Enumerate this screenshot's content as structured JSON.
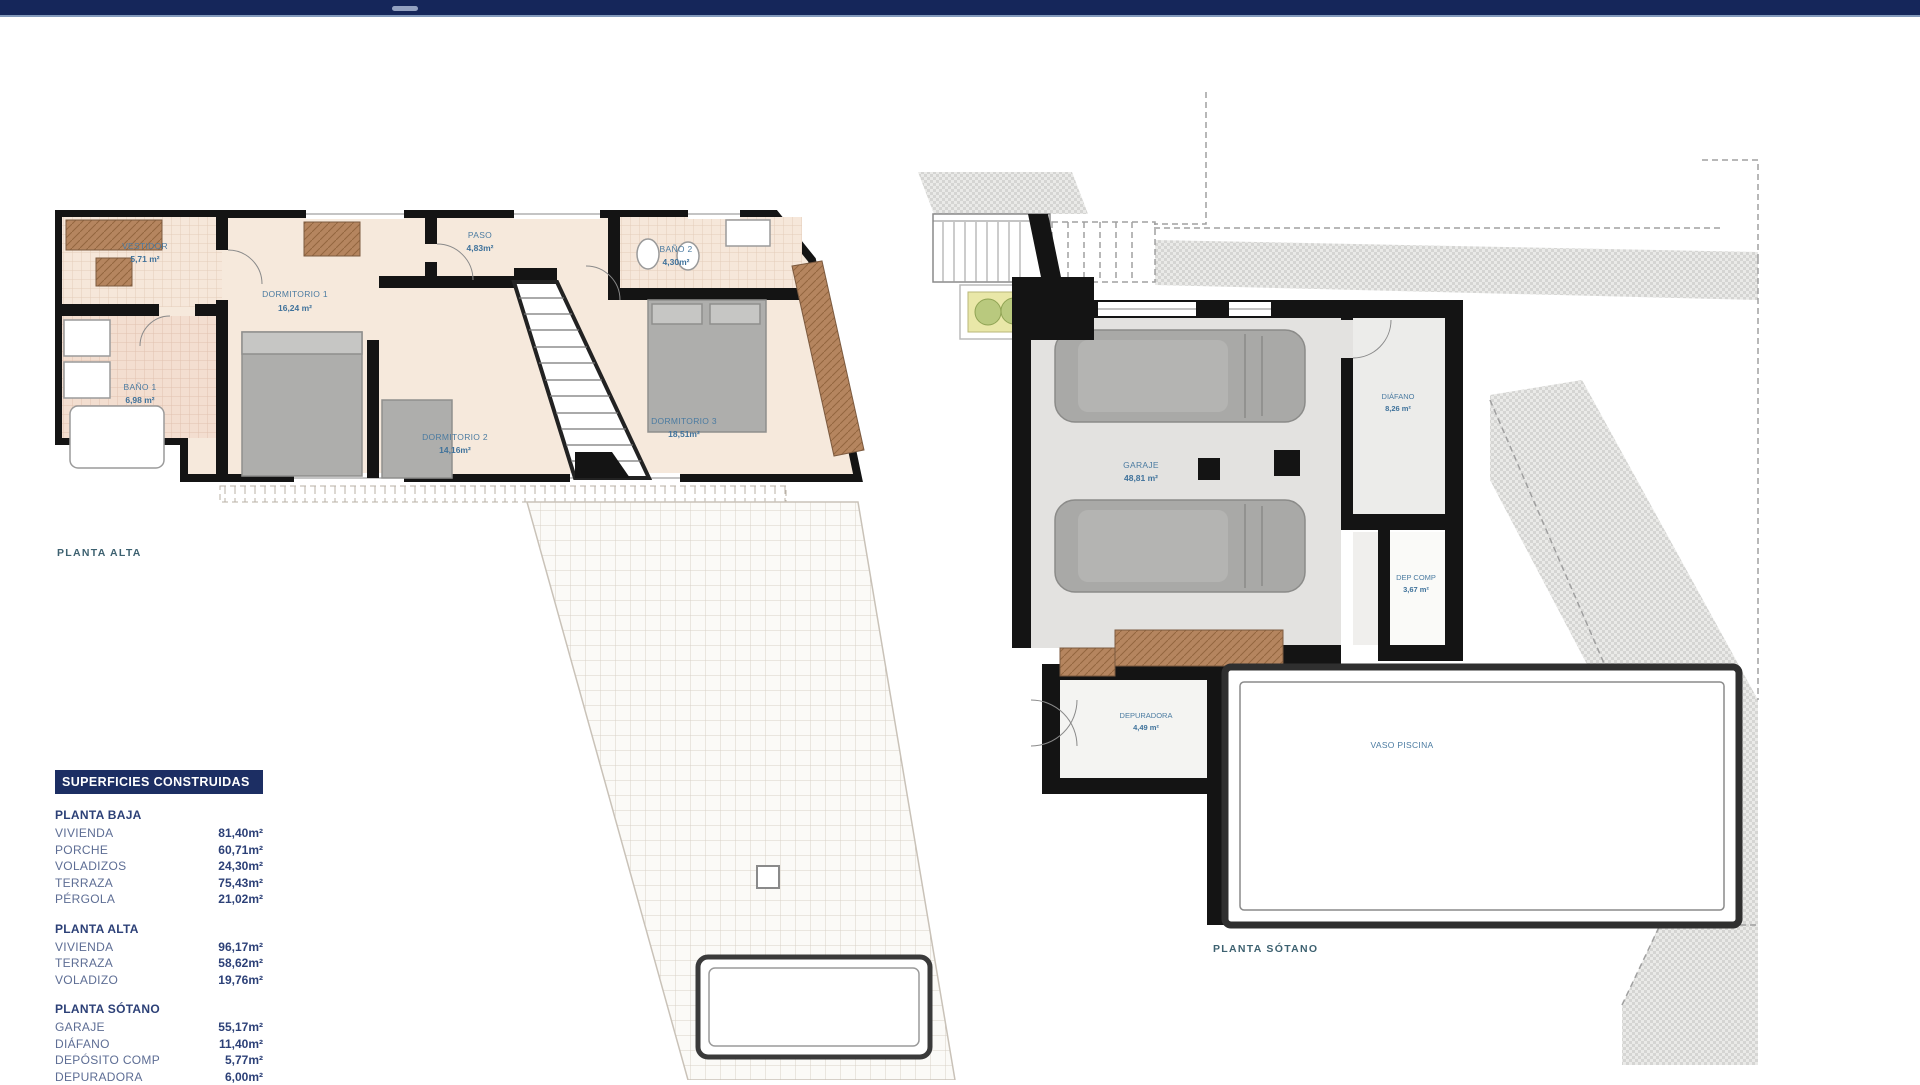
{
  "window": {
    "top_bar_color": "#15265a"
  },
  "plans": {
    "planta_alta": {
      "caption": "PLANTA ALTA",
      "rooms": {
        "vestidor": {
          "name": "VESTIDOR",
          "area": "5,71 m²"
        },
        "paso": {
          "name": "PASO",
          "area": "4,83m²"
        },
        "bano2": {
          "name": "BAÑO 2",
          "area": "4,30m²"
        },
        "dormitorio1": {
          "name": "DORMITORIO 1",
          "area": "16,24 m²"
        },
        "bano1": {
          "name": "BAÑO 1",
          "area": "6,98 m²"
        },
        "dormitorio2": {
          "name": "DORMITORIO 2",
          "area": "14,16m²"
        },
        "dormitorio3": {
          "name": "DORMITORIO 3",
          "area": "18,51m²"
        }
      }
    },
    "planta_sotano": {
      "caption": "PLANTA SÓTANO",
      "rooms": {
        "garaje": {
          "name": "GARAJE",
          "area": "48,81 m²"
        },
        "diafano": {
          "name": "DIÁFANO",
          "area": "8,26 m²"
        },
        "dep_comp": {
          "name": "DEP COMP",
          "area": "3,67 m²"
        },
        "depuradora": {
          "name": "DEPURADORA",
          "area": "4,49 m²"
        },
        "vaso_piscina": {
          "name": "VASO PISCINA"
        }
      }
    }
  },
  "legend": {
    "title": "SUPERFICIES CONSTRUIDAS",
    "sections": [
      {
        "heading": "PLANTA BAJA",
        "rows": [
          {
            "label": "VIVIENDA",
            "value": "81,40m²"
          },
          {
            "label": "PORCHE",
            "value": "60,71m²"
          },
          {
            "label": "VOLADIZOS",
            "value": "24,30m²"
          },
          {
            "label": "TERRAZA",
            "value": "75,43m²"
          },
          {
            "label": "PÉRGOLA",
            "value": "21,02m²"
          }
        ]
      },
      {
        "heading": "PLANTA ALTA",
        "rows": [
          {
            "label": "VIVIENDA",
            "value": "96,17m²"
          },
          {
            "label": "TERRAZA",
            "value": "58,62m²"
          },
          {
            "label": "VOLADIZO",
            "value": "19,76m²"
          }
        ]
      },
      {
        "heading": "PLANTA SÓTANO",
        "rows": [
          {
            "label": "GARAJE",
            "value": "55,17m²"
          },
          {
            "label": "DIÁFANO",
            "value": "11,40m²"
          },
          {
            "label": "DEPÓSITO COMP",
            "value": "5,77m²"
          },
          {
            "label": "DEPURADORA",
            "value": "6,00m²"
          }
        ]
      }
    ]
  },
  "colors": {
    "accent_navy": "#1c2e63",
    "wall_black": "#141414",
    "room_beige": "#f6e9dc",
    "wardrobe_brown": "#b5855f",
    "furniture_gray": "#aeaeac",
    "label_blue": "#4b7ba1",
    "caption_teal": "#3d6170"
  }
}
